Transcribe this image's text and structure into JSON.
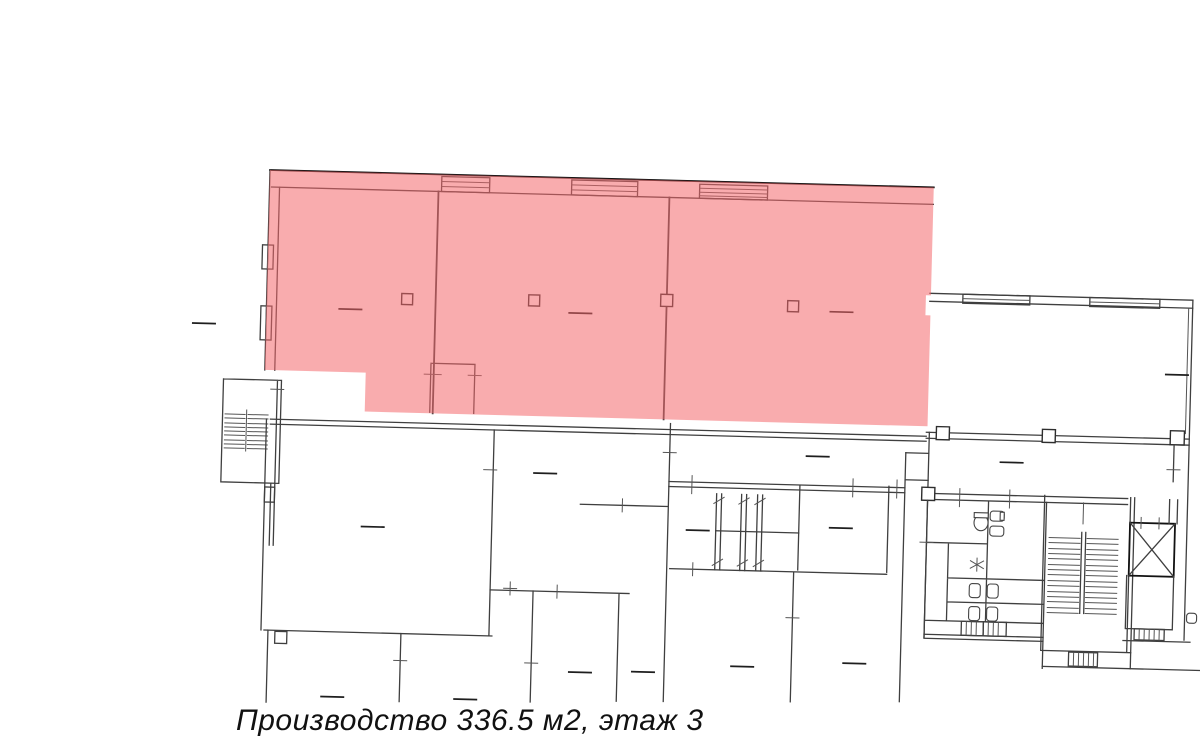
{
  "caption": {
    "text": "Производство 336.5 м2, этаж 3"
  },
  "highlight": {
    "label": "Производство",
    "area_m2": "336.5",
    "floor": "3",
    "color": "#f4676b",
    "opacity": "0.55"
  },
  "plan": {
    "background": "#ffffff",
    "wall_color": "#3f3f3f",
    "outer_wall_color": "#121212"
  }
}
